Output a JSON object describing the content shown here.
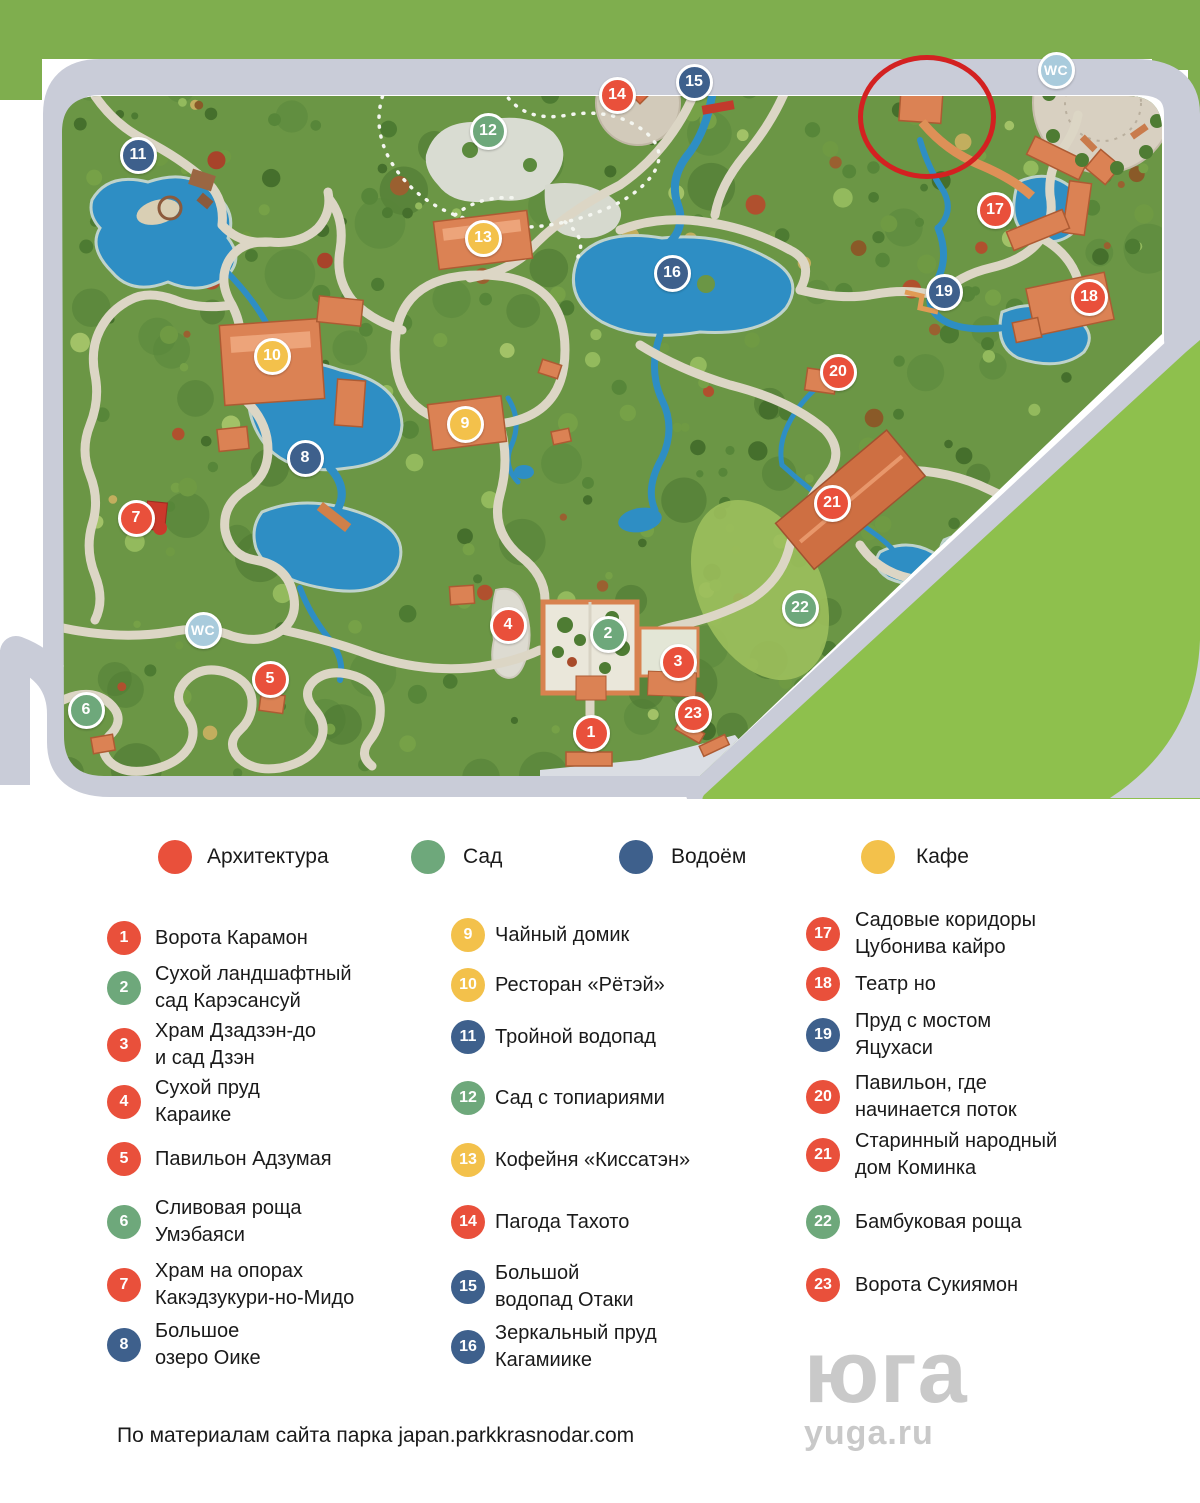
{
  "colors": {
    "architecture": "#e9503b",
    "garden": "#6ea87b",
    "water": "#3e608c",
    "cafe": "#f3c14b",
    "wc": "#a9cbdc",
    "annotation": "#d32121"
  },
  "map": {
    "markers": [
      {
        "n": "1",
        "type": "architecture",
        "x": 591,
        "y": 733
      },
      {
        "n": "2",
        "type": "garden",
        "x": 608,
        "y": 634
      },
      {
        "n": "3",
        "type": "architecture",
        "x": 678,
        "y": 662
      },
      {
        "n": "4",
        "type": "architecture",
        "x": 508,
        "y": 625
      },
      {
        "n": "5",
        "type": "architecture",
        "x": 270,
        "y": 679
      },
      {
        "n": "6",
        "type": "garden",
        "x": 86,
        "y": 710
      },
      {
        "n": "7",
        "type": "architecture",
        "x": 136,
        "y": 518
      },
      {
        "n": "8",
        "type": "water",
        "x": 305,
        "y": 458
      },
      {
        "n": "9",
        "type": "cafe",
        "x": 465,
        "y": 424
      },
      {
        "n": "10",
        "type": "cafe",
        "x": 272,
        "y": 356
      },
      {
        "n": "11",
        "type": "water",
        "x": 138,
        "y": 155
      },
      {
        "n": "12",
        "type": "garden",
        "x": 488,
        "y": 131
      },
      {
        "n": "13",
        "type": "cafe",
        "x": 483,
        "y": 238
      },
      {
        "n": "14",
        "type": "architecture",
        "x": 617,
        "y": 95
      },
      {
        "n": "15",
        "type": "water",
        "x": 694,
        "y": 82
      },
      {
        "n": "16",
        "type": "water",
        "x": 672,
        "y": 273
      },
      {
        "n": "17",
        "type": "architecture",
        "x": 995,
        "y": 210
      },
      {
        "n": "18",
        "type": "architecture",
        "x": 1089,
        "y": 297
      },
      {
        "n": "19",
        "type": "water",
        "x": 944,
        "y": 292
      },
      {
        "n": "20",
        "type": "architecture",
        "x": 838,
        "y": 372
      },
      {
        "n": "21",
        "type": "architecture",
        "x": 832,
        "y": 503
      },
      {
        "n": "22",
        "type": "garden",
        "x": 800,
        "y": 608
      },
      {
        "n": "23",
        "type": "architecture",
        "x": 693,
        "y": 714
      }
    ],
    "wc_markers": [
      {
        "label": "WC",
        "x": 1056,
        "y": 70
      },
      {
        "label": "WC",
        "x": 203,
        "y": 630
      }
    ],
    "annotation": {
      "x": 922,
      "y": 112,
      "rx": 64,
      "ry": 57
    }
  },
  "categories": [
    {
      "label": "Архитектура",
      "type": "architecture"
    },
    {
      "label": "Сад",
      "type": "garden"
    },
    {
      "label": "Водоём",
      "type": "water"
    },
    {
      "label": "Кафе",
      "type": "cafe"
    }
  ],
  "legend_columns": [
    [
      {
        "n": "1",
        "type": "architecture",
        "lines": [
          "Ворота Карамон"
        ]
      },
      {
        "n": "2",
        "type": "garden",
        "lines": [
          "Сухой ландшафтный",
          "сад Карэсансуй"
        ]
      },
      {
        "n": "3",
        "type": "architecture",
        "lines": [
          "Храм Дзадзэн-до",
          "и сад Дзэн"
        ]
      },
      {
        "n": "4",
        "type": "architecture",
        "lines": [
          "Сухой пруд",
          "Караике"
        ]
      },
      {
        "n": "5",
        "type": "architecture",
        "lines": [
          "Павильон Адзумая"
        ]
      },
      {
        "n": "6",
        "type": "garden",
        "lines": [
          "Сливовая роща",
          "Умэбаяси"
        ]
      },
      {
        "n": "7",
        "type": "architecture",
        "lines": [
          "Храм на опорах",
          "Какэдзукури-но-Мидо"
        ]
      },
      {
        "n": "8",
        "type": "water",
        "lines": [
          "Большое",
          "озеро Оике"
        ]
      }
    ],
    [
      {
        "n": "9",
        "type": "cafe",
        "lines": [
          "Чайный домик"
        ]
      },
      {
        "n": "10",
        "type": "cafe",
        "lines": [
          "Ресторан «Рётэй»"
        ]
      },
      {
        "n": "11",
        "type": "water",
        "lines": [
          "Тройной водопад"
        ]
      },
      {
        "n": "12",
        "type": "garden",
        "lines": [
          "Сад с топиариями"
        ]
      },
      {
        "n": "13",
        "type": "cafe",
        "lines": [
          "Кофейня «Киссатэн»"
        ]
      },
      {
        "n": "14",
        "type": "architecture",
        "lines": [
          "Пагода Тахото"
        ]
      },
      {
        "n": "15",
        "type": "water",
        "lines": [
          "Большой",
          "водопад Отаки"
        ]
      },
      {
        "n": "16",
        "type": "water",
        "lines": [
          "Зеркальный пруд",
          "Кагамиике"
        ]
      }
    ],
    [
      {
        "n": "17",
        "type": "architecture",
        "lines": [
          "Садовые коридоры",
          "Цубонива кайро"
        ]
      },
      {
        "n": "18",
        "type": "architecture",
        "lines": [
          "Театр но"
        ]
      },
      {
        "n": "19",
        "type": "water",
        "lines": [
          "Пруд с мостом",
          "Яцухаси"
        ]
      },
      {
        "n": "20",
        "type": "architecture",
        "lines": [
          "Павильон, где",
          "начинается поток"
        ]
      },
      {
        "n": "21",
        "type": "architecture",
        "lines": [
          "Старинный народный",
          "дом Коминка"
        ]
      },
      {
        "n": "22",
        "type": "garden",
        "lines": [
          "Бамбуковая роща"
        ]
      },
      {
        "n": "23",
        "type": "architecture",
        "lines": [
          "Ворота Сукиямон"
        ]
      }
    ]
  ],
  "footer": {
    "credit": "По материалам сайта парка japan.parkkrasnodar.com"
  },
  "watermark": {
    "logo": "юга",
    "site": "yuga.ru"
  }
}
